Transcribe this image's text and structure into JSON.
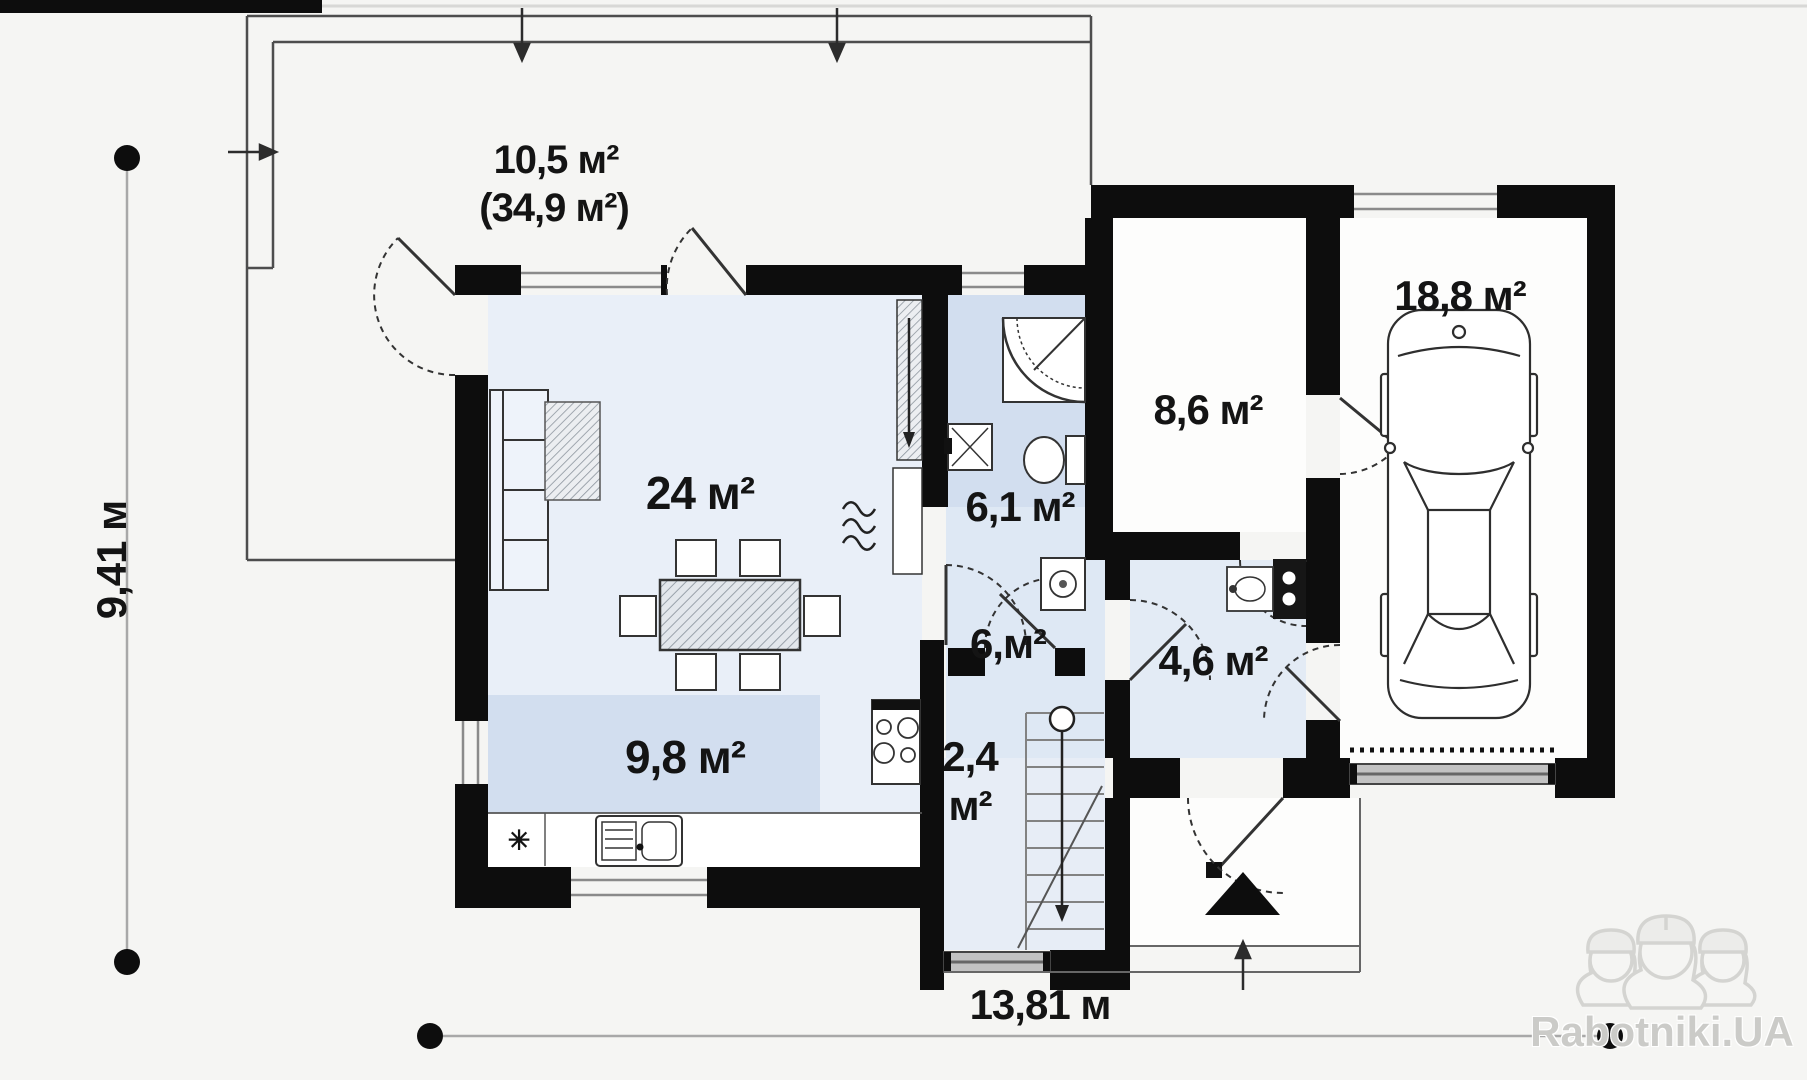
{
  "plan": {
    "type": "house-first-floor-plan",
    "labels": {
      "terrace_line1": "10,5 м²",
      "terrace_line2": "(34,9 м²)",
      "living": "24 м²",
      "kitchen": "9,8 м²",
      "bathroom": "6,1 м²",
      "hall": "6,м²",
      "corridor": "4,6 м²",
      "utility": "8,6 м²",
      "garage": "18,8 м²",
      "stairs_line1": "2,4",
      "stairs_line2": "м²",
      "star_symbol": "✳"
    },
    "dimensions": {
      "vertical": "9,41 м",
      "horizontal": "13,81 м"
    },
    "watermark": {
      "text": "Rabotniki.UA",
      "icon": "three-construction-workers"
    },
    "colors": {
      "wall": "#0d0d0d",
      "room_living": "#e9eff8",
      "room_highlight": "#d2deef",
      "room_hall": "#dee8f4",
      "dimension_line": "#a8a8a8",
      "watermark": "#cbcbc8"
    }
  }
}
